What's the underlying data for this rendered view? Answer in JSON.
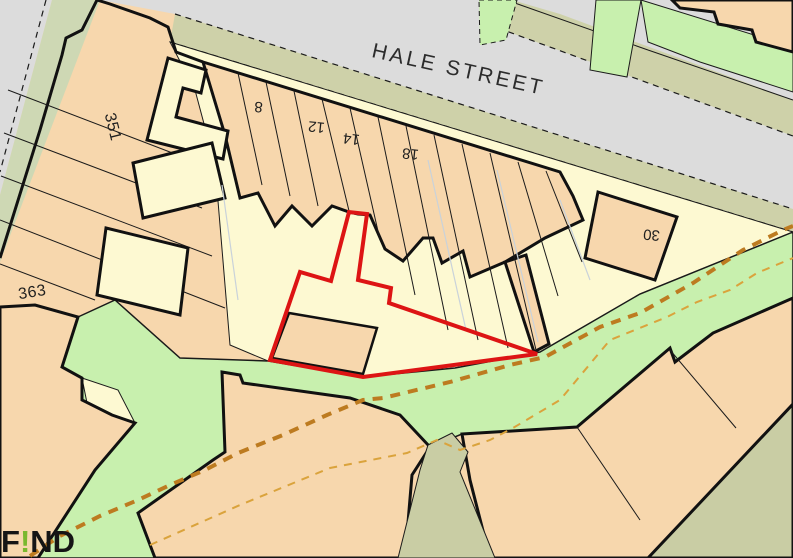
{
  "map": {
    "street_label": "HALE STREET",
    "colors": {
      "building_peach": "#f7d7ad",
      "yard_cream": "#fdf9d2",
      "green_open_space": "#c8f0ae",
      "verge_khaki": "#ced1a9",
      "verge_muted_green": "#ced8b4",
      "alley_khaki": "#c9cda4",
      "road_gray": "#dcdcdc",
      "site_boundary_red": "#dd1414",
      "footpath_orange": "#bd7b20",
      "footpath_light_orange": "#daa33c",
      "outline_black": "#111111"
    },
    "labels": [
      {
        "name": "street-label-hale-street",
        "text": "HALE STREET",
        "x": 457,
        "y": 76,
        "rotate": 12.5,
        "size": 21,
        "spacing": 3,
        "fill": "#2c2c2c"
      },
      {
        "name": "plot-label-351",
        "text": "351",
        "x": 108,
        "y": 128,
        "rotate": 76,
        "size": 16,
        "spacing": 0.5,
        "fill": "#1f1f1f"
      },
      {
        "name": "plot-label-363",
        "text": "363",
        "x": 33,
        "y": 297,
        "rotate": -9,
        "size": 16,
        "spacing": 0.5,
        "fill": "#1f1f1f"
      },
      {
        "name": "plot-label-8",
        "text": "8",
        "x": 259,
        "y": 102,
        "rotate": 185,
        "size": 15,
        "spacing": 0,
        "fill": "#1f1f1f"
      },
      {
        "name": "plot-label-12",
        "text": "12",
        "x": 317,
        "y": 122,
        "rotate": 186,
        "size": 15,
        "spacing": 0,
        "fill": "#1f1f1f"
      },
      {
        "name": "plot-label-14",
        "text": "14",
        "x": 352,
        "y": 134,
        "rotate": 187,
        "size": 15,
        "spacing": 0,
        "fill": "#1f1f1f"
      },
      {
        "name": "plot-label-18",
        "text": "18",
        "x": 411,
        "y": 149,
        "rotate": 186,
        "size": 15,
        "spacing": 0,
        "fill": "#1f1f1f"
      },
      {
        "name": "plot-label-30",
        "text": "30",
        "x": 652,
        "y": 230,
        "rotate": 185,
        "size": 15,
        "spacing": 0,
        "fill": "#1f1f1f"
      }
    ],
    "shapes": [
      {
        "name": "base-parcel-area",
        "type": "polygon",
        "points": "0,0 793,0 793,558 0,558",
        "fill": "#f7d7ad"
      },
      {
        "name": "road-left",
        "type": "polygon",
        "points": "0,0 52,0 0,195",
        "fill": "#dcdcdc"
      },
      {
        "name": "road-left-edge-dashed",
        "type": "line",
        "points": "46,0 0,172",
        "stroke": "#1a1a1a",
        "width": 1.2,
        "dash": "6 5"
      },
      {
        "name": "road-hale-street",
        "type": "polygon",
        "points": "100,0 793,0 793,210 175,14",
        "fill": "#dcdcdc"
      },
      {
        "name": "verge-left-muted-green",
        "type": "polygon",
        "points": "52,0 100,0 0,262 0,195",
        "fill": "#ced8b4"
      },
      {
        "name": "roadside-khaki-band",
        "type": "polygon",
        "points": "496,0 512,0 560,14 652,48 793,100 793,136 498,28",
        "fill": "#ced1a9"
      },
      {
        "name": "roadside-khaki-edge-dashed",
        "type": "line",
        "points": "498,28 793,136",
        "stroke": "#1a1a1a",
        "width": 1.2,
        "dash": "6 5"
      },
      {
        "name": "roadside-khaki-line-1",
        "type": "line",
        "points": "512,2 648,50",
        "stroke": "#1a1a1a",
        "width": 1
      },
      {
        "name": "roadside-khaki-line-2",
        "type": "line",
        "points": "648,50 793,100",
        "stroke": "#1a1a1a",
        "width": 1
      },
      {
        "name": "green-patch-top-1",
        "type": "polygon",
        "points": "479,0 517,0 506,40 480,45",
        "fill": "#c8f0ae",
        "stroke": "#1a1a1a",
        "width": 1,
        "dash": "5 4"
      },
      {
        "name": "green-patch-top-2",
        "type": "polygon",
        "points": "596,0 641,0 627,77 590,70",
        "fill": "#c8f0ae",
        "stroke": "#1a1a1a",
        "width": 1
      },
      {
        "name": "green-patch-top-3",
        "type": "polygon",
        "points": "641,0 793,47 793,92 700,62 648,42",
        "fill": "#c8f0ae",
        "stroke": "#1a1a1a",
        "width": 1
      },
      {
        "name": "building-top-right",
        "type": "polygon",
        "points": "672,0 793,0 793,52 756,42 752,30 718,24 714,12 680,8",
        "fill": "#f7d7ad",
        "stroke": "#111111",
        "width": 3
      },
      {
        "name": "pavement-verge-strip",
        "type": "polygon",
        "points": "175,14 793,209 793,232 170,42",
        "fill": "#ced1a9"
      },
      {
        "name": "verge-edge-dashed-top",
        "type": "line",
        "points": "175,14 793,209",
        "stroke": "#1a1a1a",
        "width": 1.2,
        "dash": "6 5"
      },
      {
        "name": "verge-edge-dashed-bottom",
        "type": "line",
        "points": "170,42 793,232",
        "stroke": "#1a1a1a",
        "width": 1.2,
        "dash": "6 5"
      },
      {
        "name": "rear-yards-cream",
        "type": "polygon",
        "points": "170,42 793,232 640,294 540,352 455,368 363,377 268,361 230,345 215,165 195,90",
        "fill": "#fdf9d2",
        "stroke": "#1a1a1a",
        "width": 1
      },
      {
        "name": "left-block-outline-west",
        "type": "polyline",
        "points": "97,0 82,30 66,38 62,55 40,130 0,258",
        "stroke": "#111111",
        "width": 3
      },
      {
        "name": "left-block-outline-north",
        "type": "polyline",
        "points": "97,0 110,4 150,18 168,27 176,52 203,62",
        "stroke": "#111111",
        "width": 3
      },
      {
        "name": "garden-line-1",
        "type": "line",
        "points": "8,90 196,162",
        "stroke": "#1a1a1a",
        "width": 1
      },
      {
        "name": "garden-line-2",
        "type": "line",
        "points": "4,133 202,208",
        "stroke": "#1a1a1a",
        "width": 1
      },
      {
        "name": "garden-line-3",
        "type": "line",
        "points": "1,176 212,256",
        "stroke": "#1a1a1a",
        "width": 1
      },
      {
        "name": "garden-line-4",
        "type": "line",
        "points": "0,220 225,308",
        "stroke": "#1a1a1a",
        "width": 1
      },
      {
        "name": "garden-line-5",
        "type": "line",
        "points": "0,264 95,300",
        "stroke": "#1a1a1a",
        "width": 1
      },
      {
        "name": "logo-area-line",
        "type": "line",
        "points": "0,538 70,558",
        "stroke": "#1a1a1a",
        "width": 1
      },
      {
        "name": "green-open-space",
        "type": "polygon",
        "points": "115,300 180,358 268,361 363,377 455,368 540,352 640,294 793,232 793,298 713,333 683,362 675,360 670,348 577,427 500,432 462,434 430,447 400,415 350,398 243,383 240,375 222,372 225,452 213,460 138,513 155,558 38,558 95,470 135,423 112,415 82,400 82,378 62,367 78,317",
        "fill": "#c8f0ae",
        "stroke": "#1a1a1a",
        "width": 1.5
      },
      {
        "name": "cream-notch-southwest",
        "type": "polygon",
        "points": "82,378 118,390 135,423 92,428",
        "fill": "#fdf9d2",
        "stroke": "#1a1a1a",
        "width": 1
      },
      {
        "name": "block-southwest",
        "type": "polygon",
        "points": "0,307 35,305 78,317 62,367 82,378 82,400 112,415 135,423 95,470 38,558 0,558",
        "fill": "#f7d7ad",
        "stroke": "#111111",
        "width": 3
      },
      {
        "name": "block-bottom-middle",
        "type": "polygon",
        "points": "222,372 240,375 243,383 350,398 400,415 430,447 412,475 405,558 155,558 138,513 213,460 225,452",
        "fill": "#f7d7ad",
        "stroke": "#111111",
        "width": 3
      },
      {
        "name": "block-southeast",
        "type": "polygon",
        "points": "462,434 577,427 670,348 675,362 713,333 793,298 793,558 490,558 470,480",
        "fill": "#f7d7ad",
        "stroke": "#111111",
        "width": 3
      },
      {
        "name": "se-block-line-1",
        "type": "line",
        "points": "577,427 640,520",
        "stroke": "#1a1a1a",
        "width": 1
      },
      {
        "name": "se-block-line-2",
        "type": "line",
        "points": "670,350 736,428",
        "stroke": "#1a1a1a",
        "width": 1
      },
      {
        "name": "khaki-corner-triangle",
        "type": "polygon",
        "points": "648,558 793,404 793,558",
        "fill": "#c9cda4",
        "stroke": "#111111",
        "width": 3
      },
      {
        "name": "alley-khaki",
        "type": "polygon",
        "points": "428,445 452,433 468,452 460,472 495,558 398,558 420,470",
        "fill": "#c9cda4",
        "stroke": "#1a1a1a",
        "width": 1
      },
      {
        "name": "terrace-row-block",
        "type": "polygon",
        "points": "203,62 560,172 573,196 583,220 545,238 505,262 470,277 463,251 442,263 433,238 423,238 403,261 385,249 370,215 358,214 349,212 332,206 312,226 292,206 275,226 258,193 240,198 225,135",
        "fill": "#f7d7ad",
        "stroke": "#111111",
        "width": 3
      },
      {
        "name": "rear-extension-building",
        "type": "polygon",
        "points": "505,262 526,255 549,344 534,352",
        "fill": "#f7d7ad",
        "stroke": "#111111",
        "width": 3
      },
      {
        "name": "building-30",
        "type": "polygon",
        "points": "598,192 677,217 655,280 585,258",
        "fill": "#f7d7ad",
        "stroke": "#111111",
        "width": 3
      },
      {
        "name": "cream-yard-L",
        "type": "polygon",
        "points": "168,58 206,70 201,93 183,88 176,117 228,131 223,159 147,140",
        "fill": "#fdf9d2",
        "stroke": "#111111",
        "width": 3
      },
      {
        "name": "cream-yard-left-a",
        "type": "polygon",
        "points": "133,163 212,143 225,198 143,218",
        "fill": "#fdf9d2",
        "stroke": "#111111",
        "width": 3
      },
      {
        "name": "cream-yard-left-b",
        "type": "polygon",
        "points": "106,228 188,248 180,315 97,295",
        "fill": "#fdf9d2",
        "stroke": "#111111",
        "width": 3
      },
      {
        "name": "plot-divider-1",
        "type": "line",
        "points": "238,73 262,185",
        "stroke": "#1a1a1a",
        "width": 1
      },
      {
        "name": "plot-divider-2",
        "type": "line",
        "points": "266,82 290,196",
        "stroke": "#1a1a1a",
        "width": 1
      },
      {
        "name": "plot-divider-3",
        "type": "line",
        "points": "294,91 318,206",
        "stroke": "#1a1a1a",
        "width": 1
      },
      {
        "name": "plot-divider-4",
        "type": "line",
        "points": "322,99 350,215",
        "stroke": "#1a1a1a",
        "width": 1
      },
      {
        "name": "plot-divider-5",
        "type": "line",
        "points": "350,108 380,240",
        "stroke": "#1a1a1a",
        "width": 1
      },
      {
        "name": "plot-divider-6",
        "type": "line",
        "points": "378,117 415,295",
        "stroke": "#1a1a1a",
        "width": 1
      },
      {
        "name": "plot-divider-7",
        "type": "line",
        "points": "406,126 448,330",
        "stroke": "#1a1a1a",
        "width": 1
      },
      {
        "name": "plot-divider-8",
        "type": "line",
        "points": "434,135 478,340",
        "stroke": "#1a1a1a",
        "width": 1
      },
      {
        "name": "plot-divider-9",
        "type": "line",
        "points": "462,144 508,348",
        "stroke": "#1a1a1a",
        "width": 1
      },
      {
        "name": "plot-divider-10",
        "type": "line",
        "points": "490,153 536,350",
        "stroke": "#1a1a1a",
        "width": 1
      },
      {
        "name": "plot-divider-11",
        "type": "line",
        "points": "518,162 558,296",
        "stroke": "#1a1a1a",
        "width": 1
      },
      {
        "name": "plot-divider-12",
        "type": "line",
        "points": "546,171 582,262",
        "stroke": "#1a1a1a",
        "width": 1
      },
      {
        "name": "faint-line-1",
        "type": "line",
        "points": "428,160 466,330",
        "stroke": "#c9d2da",
        "width": 1.2
      },
      {
        "name": "faint-line-2",
        "type": "line",
        "points": "497,170 538,342",
        "stroke": "#c9d2da",
        "width": 1.2
      },
      {
        "name": "faint-line-3",
        "type": "line",
        "points": "222,185 238,300",
        "stroke": "#c9d2da",
        "width": 1.2
      },
      {
        "name": "faint-line-4",
        "type": "line",
        "points": "560,200 590,280",
        "stroke": "#c9d2da",
        "width": 1.2
      },
      {
        "name": "building-inside-site",
        "type": "polygon",
        "points": "289,313 377,328 363,374 272,358",
        "fill": "#f7d7ad",
        "stroke": "#111111",
        "width": 2.5
      },
      {
        "name": "site-boundary-highlight",
        "type": "polygon",
        "points": "349,212 331,281 300,272 270,360 363,377 537,354 389,303 391,288 358,280 367,214",
        "fill": "none",
        "stroke": "#dd1414",
        "width": 4
      },
      {
        "name": "footpath-dashed-main",
        "type": "polyline",
        "points": "30,556 60,536 100,516 138,500 170,485 205,470 238,453 283,435 327,415 363,400 383,398 450,382 510,365 545,357 600,327 640,313 693,283 743,250 783,230 793,226",
        "stroke": "#bd7b20",
        "width": 4,
        "dash": "10 8"
      },
      {
        "name": "footpath-dashed-light",
        "type": "polyline",
        "points": "150,545 240,505 330,468 407,453 437,440 460,450 490,440 513,428 560,400 610,340 667,317 697,302 730,290 757,273 793,258",
        "stroke": "#daa33c",
        "width": 2,
        "dash": "8 7"
      }
    ]
  },
  "logo": {
    "f": "F",
    "excl": "!",
    "nd": "ND",
    "excl_color": "#7ab82e"
  }
}
